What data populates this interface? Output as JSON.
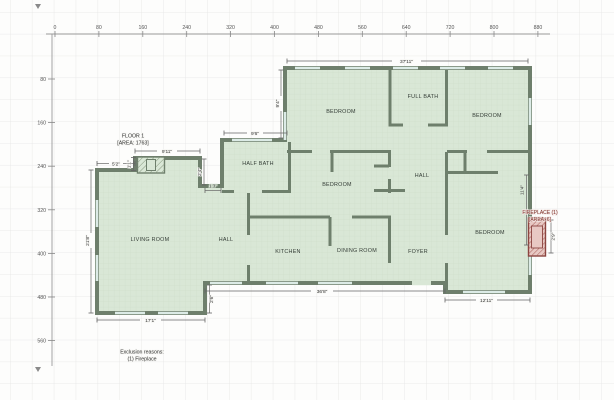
{
  "app": {
    "view": "floor-plan-canvas"
  },
  "ruler": {
    "top_labels": [
      "0",
      "80",
      "160",
      "240",
      "320",
      "400",
      "480",
      "560",
      "640",
      "720",
      "800",
      "880"
    ],
    "left_labels": [
      "80",
      "160",
      "240",
      "320",
      "400",
      "480",
      "560"
    ]
  },
  "floor": {
    "name": "FLOOR 1",
    "area": "[AREA: 1763]"
  },
  "rooms": {
    "bedroom_top_left": "BEDROOM",
    "full_bath": "FULL BATH",
    "bedroom_top_right": "BEDROOM",
    "half_bath": "HALF BATH",
    "bedroom_middle": "BEDROOM",
    "hall_upper": "HALL",
    "living_room": "LIVING ROOM",
    "hall_lower": "HALL",
    "kitchen": "KITCHEN",
    "dining_room": "DINING ROOM",
    "foyer": "FOYER",
    "bedroom_bottom_right": "BEDROOM"
  },
  "dimensions": {
    "top_width": "37'11\"",
    "upper_left_height": "9'4\"",
    "half_bath_top": "9'6\"",
    "living_top": "9'11\"",
    "living_top_left": "5'2\"",
    "living_jog_height": "1'1\"",
    "hall_jog_height": "2'4\"",
    "hall_jog_width": "1'3\"",
    "living_left": "21'8\"",
    "living_bottom": "17'1\"",
    "hall_step_height": "2'6\"",
    "main_bottom": "36'8\"",
    "bedroom_bottom": "12'11\"",
    "bedroom_right_height": "11'4\"",
    "fireplace_height": "2'9\""
  },
  "fireplace": {
    "title": "FIREPLACE (1)",
    "area": "[AREA: 6]"
  },
  "exclusions": {
    "title": "Exclusion reasons:",
    "item1": "(1) Fireplace"
  },
  "colors": {
    "wall": "#6e7f6c",
    "floor_fill": "#d9e7d6",
    "window": "#dcebe6",
    "fireplace_fill": "#e8c8c3",
    "fireplace_accent": "#8b4440",
    "fireplace_text": "#7b2d26",
    "grid": "#e5e5e5",
    "dim_line": "#666666"
  }
}
